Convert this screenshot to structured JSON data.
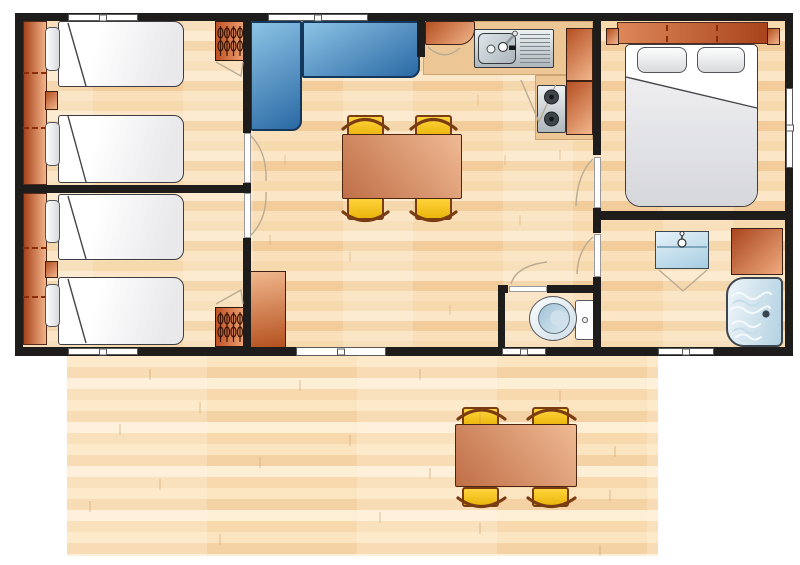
{
  "meta": {
    "type": "floor-plan",
    "view": "top-down",
    "subject": "holiday mobile-home layout with wooden deck terrace",
    "visible_text": "none"
  },
  "palette": {
    "wall": "#1e1d1b",
    "floorA": "#f7d9ae",
    "floorB": "#fbe7c8",
    "floorC": "#f2cd9b",
    "floorD": "#f9e0ba",
    "deckA": "#fbe5c0",
    "deckB": "#f5d2a3",
    "deckC": "#fdeed6",
    "deckD": "#f8d9ae",
    "counter": "#ecc795",
    "orangeDark": "#b54f22",
    "orangeLight": "#f2b68c",
    "sofaLight": "#8cc3e5",
    "sofaDark": "#2a69a4",
    "sofaBorder": "#14375c",
    "tableDark": "#c06f47",
    "tableLight": "#efba94",
    "tableBorder": "#4d2511",
    "chairLight": "#ffd43c",
    "chairDark": "#eab60d",
    "chairTrim": "#7a3c12",
    "steelLight": "#edf1f3",
    "steelDark": "#aeb7bc",
    "fixLight": "#e6f2f8",
    "fixBlue": "#a6cde2",
    "pillow": "#d9dadd",
    "bedLine": "#3c3c42",
    "lineGray": "#b9ab94",
    "hanger": "#3a1505",
    "winTrim": "#5a5a5a",
    "winWhite": "#ffffff"
  },
  "rooms": [
    {
      "id": "bedroom-twin-1",
      "position": "top-left",
      "furniture": [
        "single-bed",
        "single-bed",
        "pillow",
        "pillow",
        "headboard-shelf",
        "nightstand",
        "wardrobe-with-hangers"
      ],
      "windows": 1,
      "doors": 1
    },
    {
      "id": "bedroom-twin-2",
      "position": "bottom-left",
      "furniture": [
        "single-bed",
        "single-bed",
        "pillow",
        "pillow",
        "headboard-shelf",
        "nightstand",
        "wardrobe-with-hangers"
      ],
      "windows": 1,
      "doors": 1
    },
    {
      "id": "living-dining",
      "position": "center",
      "furniture": [
        "l-shaped-corner-sofa",
        "dining-table",
        "chair",
        "chair",
        "chair",
        "chair",
        "storage-cabinet"
      ],
      "windows": 1,
      "doors": [
        "patio-entrance"
      ]
    },
    {
      "id": "kitchen",
      "position": "top-center-right",
      "furniture": [
        "sink-with-drainer",
        "two-burner-hob",
        "corner-cabinet",
        "tall-cabinet",
        "tall-cabinet",
        "worktop"
      ]
    },
    {
      "id": "master-bedroom",
      "position": "right",
      "furniture": [
        "double-bed",
        "pillow",
        "pillow",
        "headboard-with-side-tables"
      ],
      "windows": 1,
      "doors": 1
    },
    {
      "id": "shower-room",
      "position": "bottom-right",
      "furniture": [
        "washbasin",
        "corner-shower",
        "storage-cabinet"
      ],
      "windows": 1,
      "doors": 1
    },
    {
      "id": "wc",
      "position": "bottom-center-right",
      "furniture": [
        "toilet"
      ],
      "windows": 1,
      "doors": 1
    },
    {
      "id": "terrace",
      "position": "bottom",
      "furniture": [
        "outdoor-table",
        "chair",
        "chair",
        "chair",
        "chair"
      ],
      "flooring": "wooden-decking"
    }
  ]
}
